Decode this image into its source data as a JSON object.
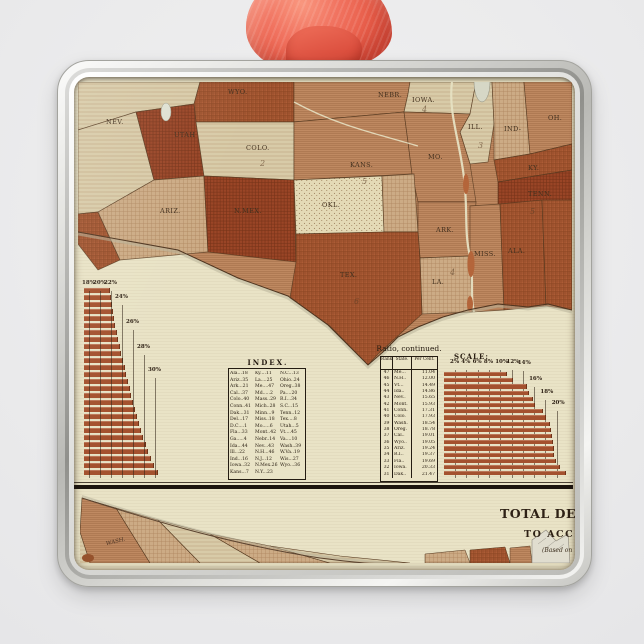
{
  "scene": {
    "background_color": "#ebebec",
    "ribbon_color": "#e85d49",
    "frame_color": "#c7c7c3",
    "paper_color": "#e9e3c6",
    "bar_color": "#a4512e"
  },
  "map": {
    "labels": [
      {
        "t": "NEV.",
        "x": 28,
        "y": 42
      },
      {
        "t": "UTAH",
        "x": 96,
        "y": 55
      },
      {
        "t": "COLO.",
        "x": 168,
        "y": 68
      },
      {
        "t": "WYO.",
        "x": 150,
        "y": 12
      },
      {
        "t": "NEBR.",
        "x": 300,
        "y": 15
      },
      {
        "t": "IOWA.",
        "x": 334,
        "y": 20
      },
      {
        "t": "KANS.",
        "x": 272,
        "y": 85
      },
      {
        "t": "MO.",
        "x": 350,
        "y": 77
      },
      {
        "t": "ILL.",
        "x": 390,
        "y": 47
      },
      {
        "t": "IND-",
        "x": 426,
        "y": 49
      },
      {
        "t": "OH.",
        "x": 470,
        "y": 38
      },
      {
        "t": "KY.",
        "x": 450,
        "y": 88
      },
      {
        "t": "TENN.",
        "x": 450,
        "y": 114
      },
      {
        "t": "ARIZ.",
        "x": 82,
        "y": 131
      },
      {
        "t": "N.MEX.",
        "x": 156,
        "y": 131
      },
      {
        "t": "OKL.",
        "x": 244,
        "y": 125
      },
      {
        "t": "ARK.",
        "x": 358,
        "y": 150
      },
      {
        "t": "MISS.",
        "x": 396,
        "y": 174
      },
      {
        "t": "ALA.",
        "x": 430,
        "y": 171
      },
      {
        "t": "LA.",
        "x": 354,
        "y": 202
      },
      {
        "t": "TEX.",
        "x": 262,
        "y": 195
      }
    ],
    "numerals": [
      {
        "t": "2",
        "x": 182,
        "y": 84
      },
      {
        "t": "4",
        "x": 344,
        "y": 30
      },
      {
        "t": "3",
        "x": 400,
        "y": 66
      },
      {
        "t": "5",
        "x": 284,
        "y": 102
      },
      {
        "t": "4",
        "x": 372,
        "y": 193
      },
      {
        "t": "5",
        "x": 452,
        "y": 132
      },
      {
        "t": "6",
        "x": 276,
        "y": 222
      }
    ]
  },
  "left_chart": {
    "tick_labels": [
      "18%",
      "20%",
      "22%",
      "24%",
      "26%",
      "28%",
      "30%"
    ],
    "bars": [
      21.6,
      21.8,
      22.0,
      22.2,
      22.4,
      22.6,
      22.9,
      23.1,
      23.4,
      23.7,
      24.0,
      24.3,
      24.6,
      24.9,
      25.2,
      25.5,
      25.8,
      26.1,
      26.5,
      26.9,
      27.3,
      27.7,
      28.1,
      28.5,
      29.0,
      29.7,
      30.4
    ]
  },
  "index_table": {
    "title": "INDEX.",
    "columns": [
      [
        "Ala...18",
        "Ariz..35",
        "Ark...21",
        "Cal...37",
        "Colo..40",
        "Conn..41",
        "Dak...31",
        "Del...17",
        "D.C....1",
        "Fla...33",
        "Ga.....4",
        "Ida...44",
        "Ill...22",
        "Ind...16",
        "Iowa..32",
        "Kans...7"
      ],
      [
        "Ky....11",
        "La....25",
        "Me....47",
        "Md.....2",
        "Mass..29",
        "Mich..28",
        "Minn...9",
        "Miss..18",
        "Mo.....6",
        "Mont..42",
        "Nebr..14",
        "Nev...43",
        "N.H...46",
        "N.J...12",
        "N.Mex.26",
        "N.Y...23"
      ],
      [
        "N.C...13",
        "Ohio..24",
        "Oreg..38",
        "Pa....20",
        "R.I...34",
        "S.C...15",
        "Tenn..12",
        "Tex....8",
        "Utah...5",
        "Vt....45",
        "Va....10",
        "Wash..39",
        "W.Va..19",
        "Wis...27",
        "Wyo...36"
      ]
    ]
  },
  "ratio_table": {
    "title": "Ratio, continued.",
    "headers": [
      "Rank",
      "State.",
      "Per Cent."
    ],
    "rows": [
      [
        "47",
        "Me...",
        "11.04"
      ],
      [
        "46",
        "N.H..",
        "12.00"
      ],
      [
        "45",
        "Vt...",
        "14.49"
      ],
      [
        "44",
        "Ida..",
        "14.86"
      ],
      [
        "43",
        "Nev..",
        "15.65"
      ],
      [
        "42",
        "Mont.",
        "15.93"
      ],
      [
        "41",
        "Conn.",
        "17.31"
      ],
      [
        "40",
        "Colo.",
        "17.93"
      ],
      [
        "39",
        "Wash.",
        "18.54"
      ],
      [
        "38",
        "Oreg.",
        "18.78"
      ],
      [
        "37",
        "Cal..",
        "19.01"
      ],
      [
        "36",
        "Wyo..",
        "19.05"
      ],
      [
        "35",
        "Ariz.",
        "19.24"
      ],
      [
        "34",
        "R.I..",
        "19.37"
      ],
      [
        "33",
        "Fla..",
        "19.69"
      ],
      [
        "32",
        "Iowa.",
        "20.33"
      ],
      [
        "31",
        "Dak..",
        "21.47"
      ]
    ]
  },
  "scale_chart": {
    "title": "SCALE:",
    "tick_labels": [
      "2%",
      "4%",
      "6%",
      "8%",
      "10%",
      "12%",
      "14%",
      "16%",
      "18%",
      "20%"
    ]
  },
  "bottom_map": {
    "label_wash": "WASH.",
    "title": "TOTAL DEAT",
    "subtitle": "TO ACC",
    "note": "(Based on"
  }
}
